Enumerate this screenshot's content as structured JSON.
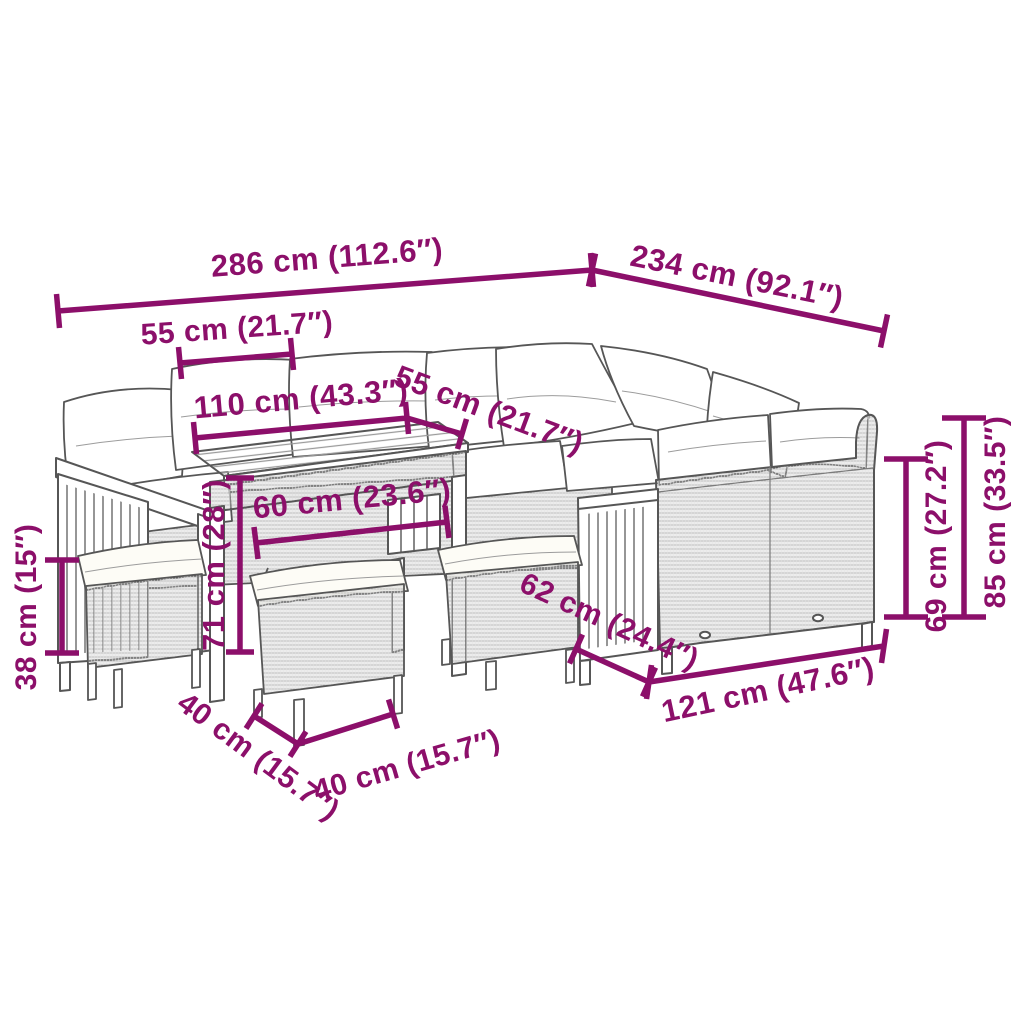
{
  "diagram": {
    "alt": "Dimension diagram of a poly rattan garden lounge set: corner sofa with cushions, wood-top table and three stools",
    "unit_primary": "cm",
    "unit_secondary": "inches",
    "style": {
      "dimension_color": "#8c0f6a",
      "line_art_color": "#565656",
      "cushion_color": "#ffffff",
      "background": "#ffffff"
    },
    "measurements": [
      {
        "id": "total-width",
        "cm": 286,
        "inches": 112.6,
        "label": "286 cm (112.6″)"
      },
      {
        "id": "total-depth",
        "cm": 234,
        "inches": 92.1,
        "label": "234 cm (92.1″)"
      },
      {
        "id": "seat-width-left",
        "cm": 55,
        "inches": 21.7,
        "label": "55 cm (21.7″)"
      },
      {
        "id": "table-length",
        "cm": 110,
        "inches": 43.3,
        "label": "110 cm (43.3″)"
      },
      {
        "id": "seat-width-corner",
        "cm": 55,
        "inches": 21.7,
        "label": "55 cm (21.7″)"
      },
      {
        "id": "seat-depth-front",
        "cm": 60,
        "inches": 23.6,
        "label": "60 cm (23.6″)"
      },
      {
        "id": "table-height",
        "cm": 71,
        "inches": 28,
        "label": "71 cm (28″)"
      },
      {
        "id": "stool-height",
        "cm": 38,
        "inches": 15,
        "label": "38 cm (15″)"
      },
      {
        "id": "back-height",
        "cm": 69,
        "inches": 27.2,
        "label": "69 cm (27.2″)"
      },
      {
        "id": "total-height",
        "cm": 85,
        "inches": 33.5,
        "label": "85 cm (33.5″)"
      },
      {
        "id": "sofa-depth-right",
        "cm": 62,
        "inches": 24.4,
        "label": "62 cm (24.4″)"
      },
      {
        "id": "sofa-length-right",
        "cm": 121,
        "inches": 47.6,
        "label": "121 cm (47.6″)"
      },
      {
        "id": "stool-depth",
        "cm": 40,
        "inches": 15.7,
        "label": "40 cm (15.7″)"
      },
      {
        "id": "stool-width",
        "cm": 40,
        "inches": 15.7,
        "label": "40 cm (15.7″)"
      }
    ]
  }
}
